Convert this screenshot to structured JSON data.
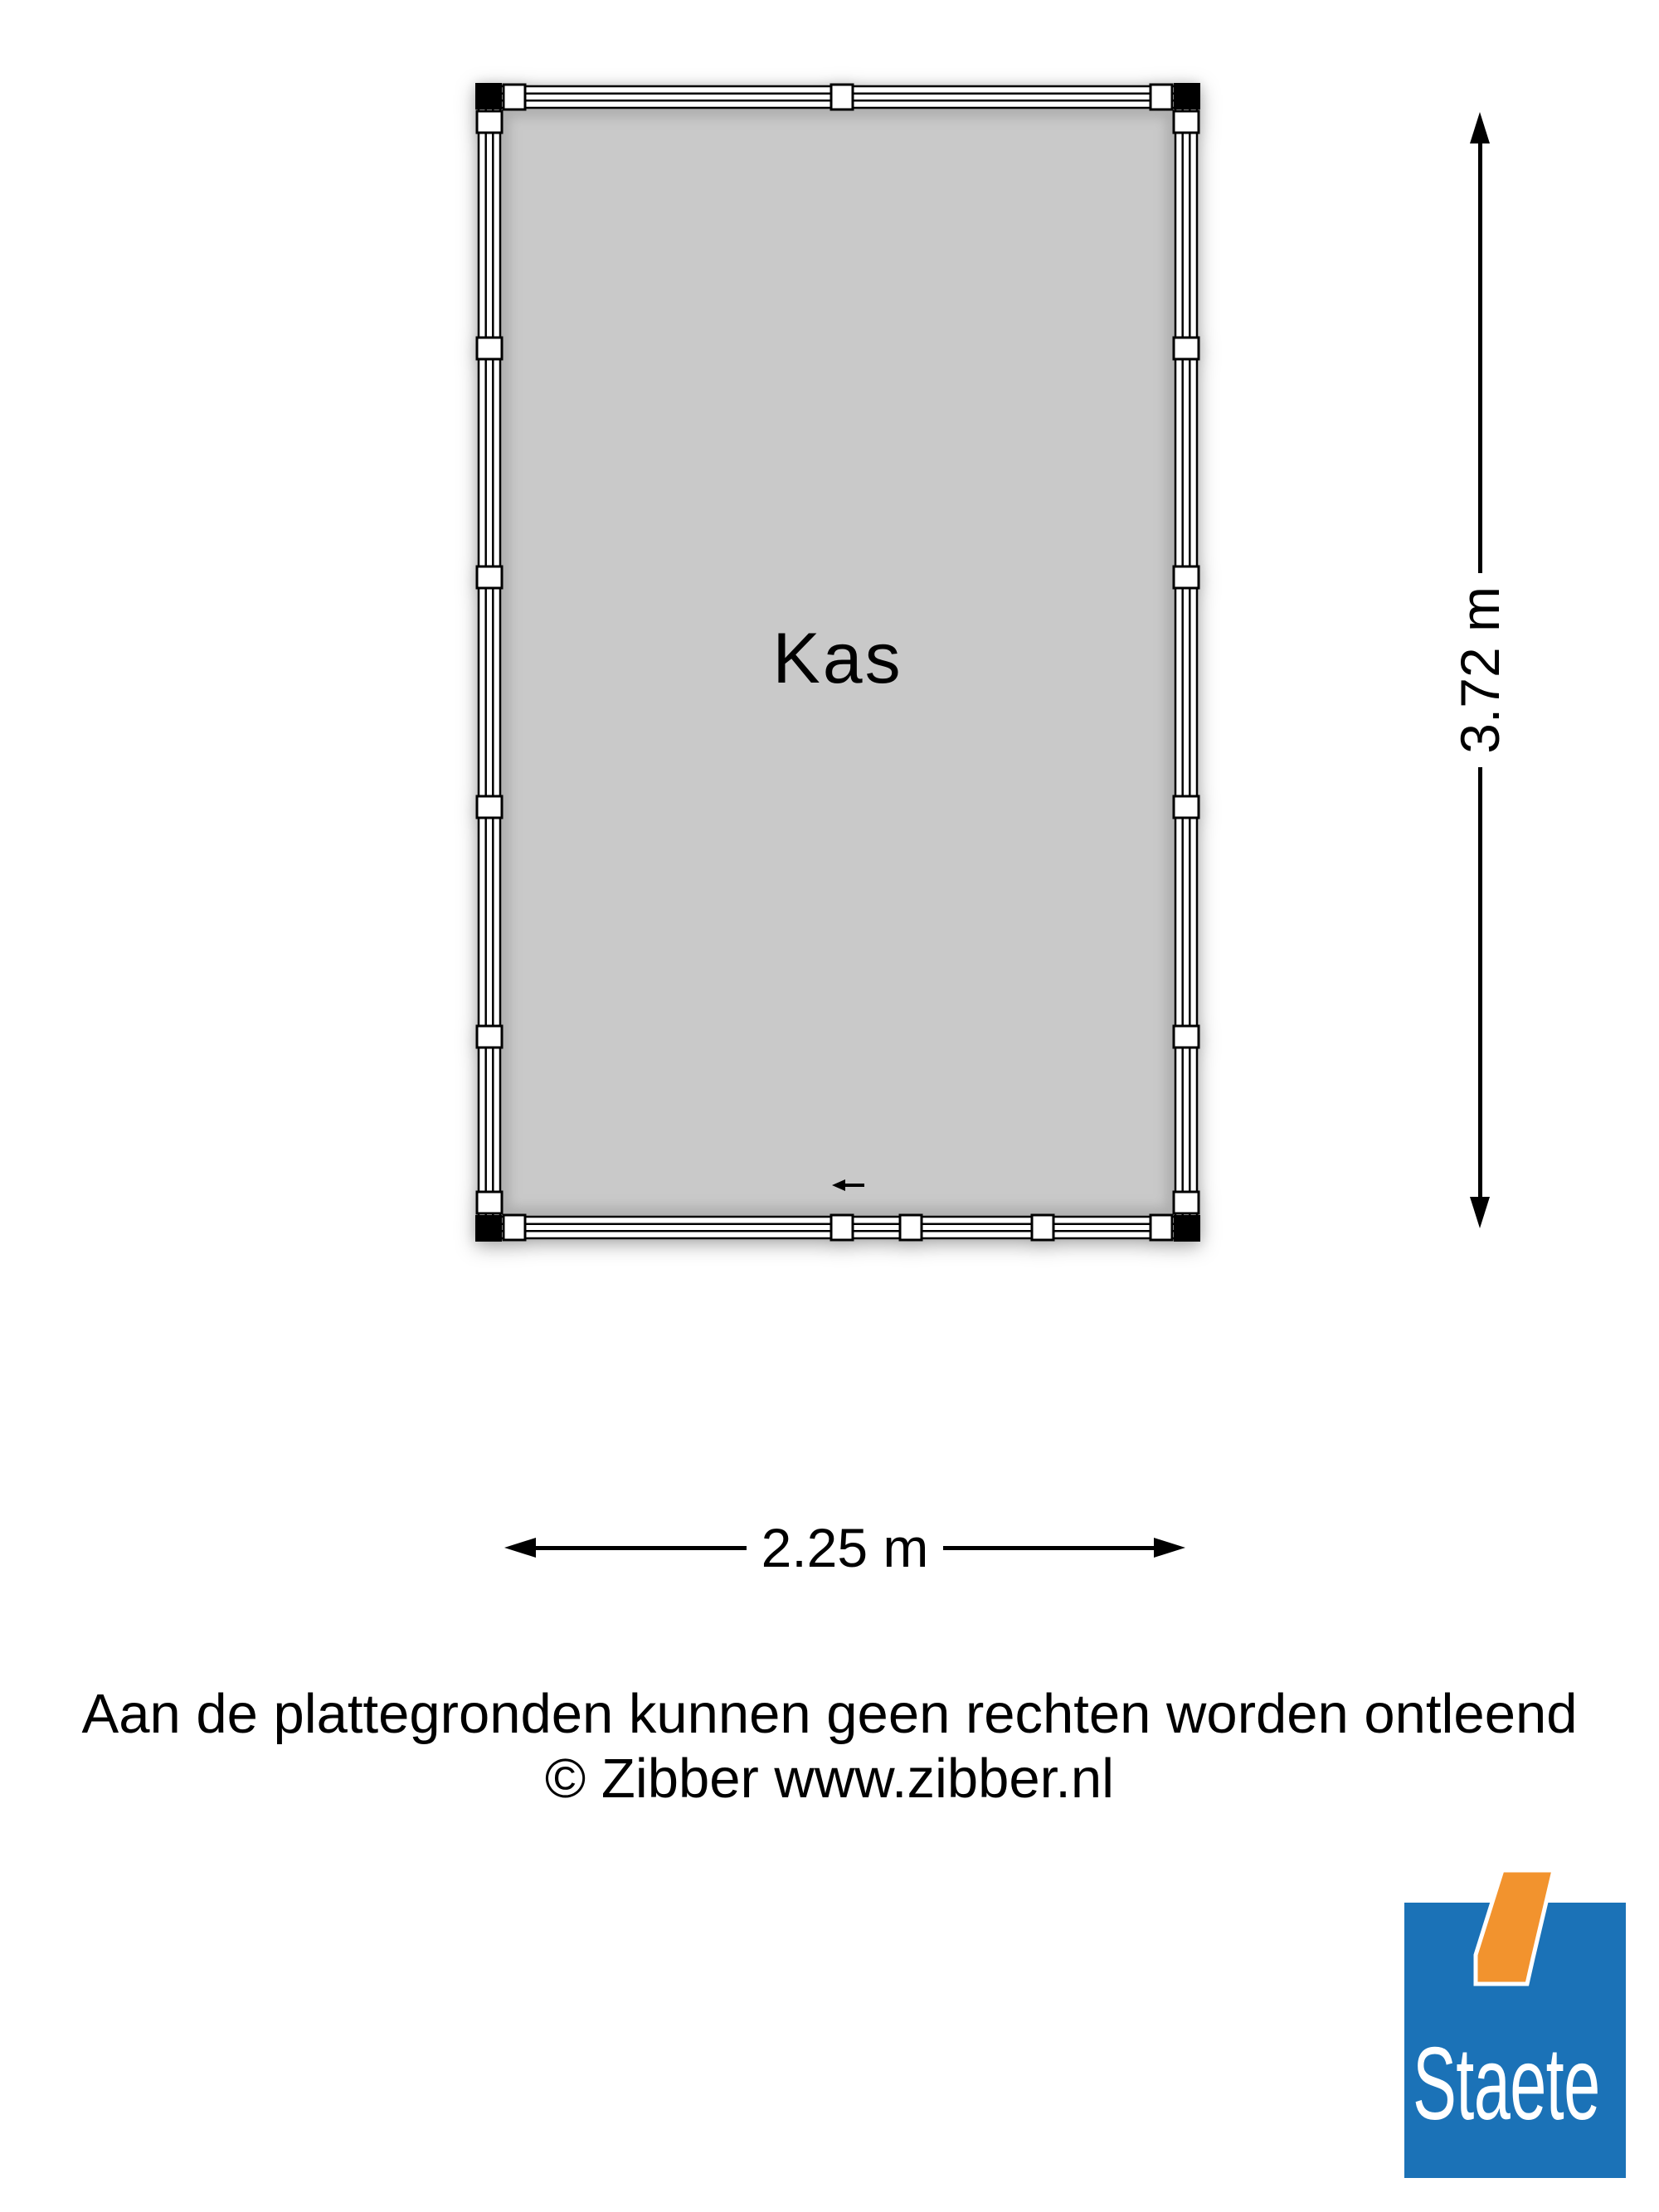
{
  "floorplan": {
    "room": {
      "label": "Kas",
      "fill": "#c9c9c9"
    },
    "line_color": "#000000",
    "entrance_icon": "arrow-left"
  },
  "dimensions": {
    "vertical": {
      "label": "3.72 m",
      "icons": [
        "arrow-up",
        "arrow-down"
      ]
    },
    "horizontal": {
      "label": "2.25 m",
      "icons": [
        "arrow-left",
        "arrow-right"
      ]
    }
  },
  "footer": {
    "disclaimer": "Aan de plattegronden kunnen geen rechten worden ontleend",
    "copyright": "© Zibber www.zibber.nl"
  },
  "logo": {
    "text": "Staete",
    "blue": "#1b72b7",
    "orange": "#f2932e",
    "text_color": "#ffffff"
  }
}
